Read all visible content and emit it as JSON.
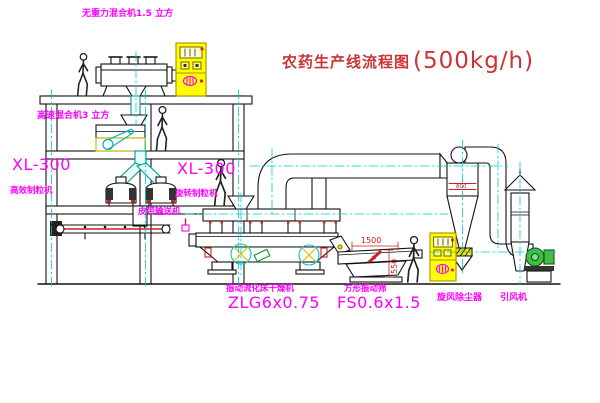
{
  "title": {
    "text": "农药生产线流程图",
    "capacity": "(500kg/h)"
  },
  "equipment_labels": {
    "gravity_mixer": "无重力混合机1.5 立方",
    "high_speed_mixer": "高速混合机3 立方",
    "granulator_left_model": "XL-300",
    "granulator_left_name": "高效制粒机",
    "granulator_right_model": "XL-300",
    "granulator_right_name": "旋转制粒机",
    "belt_conveyor": "皮带输送机",
    "dryer_name": "振动流化床干燥机",
    "dryer_model": "ZLG6x0.75",
    "sieve_name": "方形振动筛",
    "sieve_model": "FS0.6x1.5",
    "cyclone": "旋风除尘器",
    "fan": "引风机"
  },
  "dimensions": {
    "sieve_length": "1500",
    "sieve_height": "550",
    "cyclone_band": "800"
  },
  "colors": {
    "label_magenta": "#ff00ff",
    "title_red": "#cc3333",
    "dimension_red": "#cc2222",
    "cabinet_yellow": "#ffff00",
    "centerline_cyan": "#00cccc",
    "fan_green": "#44bb44",
    "line_black": "#111111",
    "background": "#ffffff"
  }
}
